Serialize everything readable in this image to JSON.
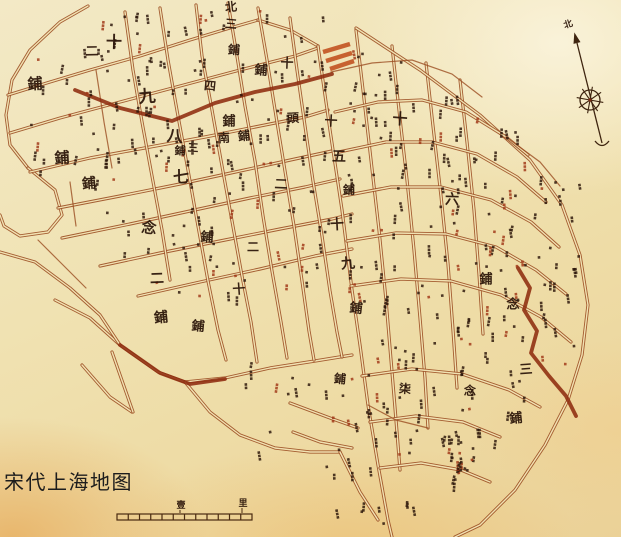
{
  "caption": {
    "text": "宋代上海地图"
  },
  "colors": {
    "ink": "#2a1408",
    "street": "#9b4e22",
    "street_inner": "#f1e2b2",
    "accent": "#8e2c0f",
    "red_block": "#c04a18",
    "red_mark": "#a03616",
    "compass": "#3f2510",
    "scale": "#4a2a10"
  },
  "compass": {
    "north_label": "北",
    "label_pos": [
      569,
      27
    ],
    "top": [
      577,
      43
    ],
    "bottom": [
      602,
      143
    ],
    "wheel_center": [
      590,
      100
    ],
    "wheel_radius": 10
  },
  "scale_bar": {
    "x1": 117,
    "x2": 252,
    "y": 514,
    "height": 6,
    "segments": 12,
    "labels": [
      {
        "text": "壹",
        "x": 181,
        "y": 508
      },
      {
        "text": "里",
        "x": 243,
        "y": 506
      }
    ]
  },
  "district_labels": [
    {
      "t": "北",
      "x": 231,
      "y": 7,
      "s": 12
    },
    {
      "t": "三",
      "x": 231,
      "y": 24,
      "s": 12
    },
    {
      "t": "鋪",
      "x": 234,
      "y": 50,
      "s": 12
    },
    {
      "t": "十",
      "x": 114,
      "y": 42,
      "s": 16
    },
    {
      "t": "二",
      "x": 92,
      "y": 52,
      "s": 13
    },
    {
      "t": "鋪",
      "x": 35,
      "y": 84,
      "s": 15
    },
    {
      "t": "九",
      "x": 147,
      "y": 97,
      "s": 17
    },
    {
      "t": "四",
      "x": 210,
      "y": 86,
      "s": 12
    },
    {
      "t": "鋪",
      "x": 261,
      "y": 71,
      "s": 13
    },
    {
      "t": "十",
      "x": 287,
      "y": 64,
      "s": 13
    },
    {
      "t": "鋪",
      "x": 229,
      "y": 122,
      "s": 13
    },
    {
      "t": "頭",
      "x": 293,
      "y": 118,
      "s": 12
    },
    {
      "t": "南",
      "x": 224,
      "y": 138,
      "s": 12
    },
    {
      "t": "鋪",
      "x": 244,
      "y": 136,
      "s": 12
    },
    {
      "t": "八",
      "x": 175,
      "y": 136,
      "s": 16
    },
    {
      "t": "三",
      "x": 193,
      "y": 148,
      "s": 11
    },
    {
      "t": "鋪",
      "x": 180,
      "y": 151,
      "s": 11
    },
    {
      "t": "七",
      "x": 181,
      "y": 177,
      "s": 16
    },
    {
      "t": "鋪",
      "x": 62,
      "y": 158,
      "s": 15
    },
    {
      "t": "鋪",
      "x": 89,
      "y": 184,
      "s": 14
    },
    {
      "t": "念",
      "x": 149,
      "y": 228,
      "s": 15
    },
    {
      "t": "鋪",
      "x": 207,
      "y": 238,
      "s": 13
    },
    {
      "t": "二",
      "x": 281,
      "y": 185,
      "s": 13
    },
    {
      "t": "二",
      "x": 253,
      "y": 247,
      "s": 12
    },
    {
      "t": "二",
      "x": 157,
      "y": 279,
      "s": 14
    },
    {
      "t": "十",
      "x": 239,
      "y": 290,
      "s": 13
    },
    {
      "t": "鋪",
      "x": 161,
      "y": 318,
      "s": 14
    },
    {
      "t": "鋪",
      "x": 198,
      "y": 327,
      "s": 13
    },
    {
      "t": "十",
      "x": 331,
      "y": 122,
      "s": 13
    },
    {
      "t": "五",
      "x": 339,
      "y": 157,
      "s": 14
    },
    {
      "t": "鋪",
      "x": 349,
      "y": 190,
      "s": 12
    },
    {
      "t": "十",
      "x": 337,
      "y": 225,
      "s": 14
    },
    {
      "t": "九",
      "x": 348,
      "y": 264,
      "s": 14
    },
    {
      "t": "鋪",
      "x": 356,
      "y": 309,
      "s": 13
    },
    {
      "t": "十",
      "x": 400,
      "y": 119,
      "s": 15
    },
    {
      "t": "六",
      "x": 452,
      "y": 200,
      "s": 14
    },
    {
      "t": "鋪",
      "x": 486,
      "y": 280,
      "s": 13
    },
    {
      "t": "念",
      "x": 513,
      "y": 305,
      "s": 13
    },
    {
      "t": "三",
      "x": 526,
      "y": 370,
      "s": 13
    },
    {
      "t": "鋪",
      "x": 516,
      "y": 419,
      "s": 13
    },
    {
      "t": "鋪",
      "x": 340,
      "y": 379,
      "s": 12
    },
    {
      "t": "柒",
      "x": 405,
      "y": 389,
      "s": 12
    },
    {
      "t": "念",
      "x": 470,
      "y": 391,
      "s": 12
    }
  ],
  "streets": {
    "main": [
      [
        [
          88,
          6
        ],
        [
          60,
          22
        ],
        [
          30,
          50
        ],
        [
          12,
          80
        ],
        [
          6,
          115
        ],
        [
          10,
          145
        ],
        [
          28,
          168
        ]
      ],
      [
        [
          28,
          168
        ],
        [
          55,
          190
        ],
        [
          62,
          215
        ],
        [
          48,
          232
        ],
        [
          20,
          236
        ],
        [
          4,
          226
        ],
        [
          0,
          215
        ]
      ],
      [
        [
          8,
          95
        ],
        [
          50,
          82
        ],
        [
          90,
          70
        ],
        [
          140,
          56
        ],
        [
          190,
          40
        ],
        [
          230,
          28
        ],
        [
          258,
          20
        ]
      ],
      [
        [
          258,
          20
        ],
        [
          290,
          30
        ],
        [
          318,
          46
        ]
      ],
      [
        [
          10,
          133
        ],
        [
          60,
          118
        ],
        [
          120,
          102
        ],
        [
          180,
          86
        ],
        [
          240,
          70
        ],
        [
          295,
          56
        ],
        [
          318,
          48
        ]
      ],
      [
        [
          30,
          172
        ],
        [
          90,
          158
        ],
        [
          150,
          147
        ],
        [
          205,
          137
        ],
        [
          255,
          127
        ],
        [
          305,
          117
        ],
        [
          328,
          110
        ]
      ],
      [
        [
          58,
          208
        ],
        [
          120,
          196
        ],
        [
          180,
          184
        ],
        [
          240,
          171
        ],
        [
          295,
          159
        ],
        [
          332,
          151
        ]
      ],
      [
        [
          62,
          238
        ],
        [
          130,
          224
        ],
        [
          190,
          211
        ],
        [
          250,
          198
        ],
        [
          305,
          187
        ],
        [
          340,
          179
        ]
      ],
      [
        [
          100,
          266
        ],
        [
          160,
          253
        ],
        [
          220,
          241
        ],
        [
          280,
          229
        ],
        [
          332,
          219
        ],
        [
          352,
          214
        ]
      ],
      [
        [
          138,
          296
        ],
        [
          200,
          282
        ],
        [
          260,
          269
        ],
        [
          315,
          256
        ],
        [
          352,
          249
        ]
      ],
      [
        [
          55,
          300
        ],
        [
          90,
          318
        ],
        [
          120,
          345
        ],
        [
          158,
          372
        ],
        [
          185,
          382
        ],
        [
          225,
          378
        ],
        [
          270,
          368
        ],
        [
          315,
          361
        ],
        [
          352,
          355
        ]
      ],
      [
        [
          125,
          12
        ],
        [
          133,
          70
        ],
        [
          142,
          122
        ],
        [
          152,
          176
        ],
        [
          162,
          230
        ],
        [
          170,
          280
        ]
      ],
      [
        [
          160,
          8
        ],
        [
          168,
          60
        ],
        [
          178,
          116
        ],
        [
          188,
          170
        ],
        [
          198,
          226
        ],
        [
          208,
          281
        ],
        [
          218,
          330
        ],
        [
          226,
          360
        ]
      ],
      [
        [
          196,
          5
        ],
        [
          202,
          56
        ],
        [
          212,
          110
        ],
        [
          222,
          166
        ],
        [
          232,
          221
        ],
        [
          242,
          276
        ],
        [
          251,
          322
        ],
        [
          257,
          362
        ]
      ],
      [
        [
          228,
          3
        ],
        [
          236,
          50
        ],
        [
          245,
          106
        ],
        [
          255,
          161
        ],
        [
          263,
          216
        ],
        [
          272,
          271
        ],
        [
          281,
          322
        ],
        [
          287,
          358
        ]
      ],
      [
        [
          258,
          8
        ],
        [
          267,
          60
        ],
        [
          276,
          116
        ],
        [
          285,
          171
        ],
        [
          294,
          226
        ],
        [
          302,
          281
        ],
        [
          309,
          331
        ],
        [
          314,
          360
        ]
      ],
      [
        [
          290,
          18
        ],
        [
          297,
          70
        ],
        [
          305,
          126
        ],
        [
          313,
          181
        ],
        [
          322,
          236
        ],
        [
          330,
          291
        ],
        [
          337,
          332
        ],
        [
          342,
          357
        ]
      ],
      [
        [
          318,
          46
        ],
        [
          330,
          130
        ],
        [
          342,
          210
        ],
        [
          352,
          290
        ],
        [
          360,
          345
        ],
        [
          368,
          405
        ],
        [
          378,
          465
        ],
        [
          388,
          520
        ],
        [
          392,
          537
        ]
      ],
      [
        [
          356,
          30
        ],
        [
          363,
          90
        ],
        [
          371,
          160
        ],
        [
          379,
          230
        ],
        [
          386,
          300
        ],
        [
          391,
          360
        ],
        [
          396,
          420
        ],
        [
          400,
          470
        ]
      ],
      [
        [
          392,
          46
        ],
        [
          399,
          110
        ],
        [
          407,
          180
        ],
        [
          414,
          250
        ],
        [
          420,
          318
        ],
        [
          425,
          378
        ],
        [
          428,
          428
        ]
      ],
      [
        [
          426,
          63
        ],
        [
          433,
          126
        ],
        [
          441,
          196
        ],
        [
          448,
          264
        ],
        [
          453,
          330
        ],
        [
          457,
          388
        ]
      ],
      [
        [
          460,
          80
        ],
        [
          467,
          142
        ],
        [
          474,
          210
        ],
        [
          479,
          274
        ],
        [
          483,
          334
        ]
      ],
      [
        [
          356,
          28
        ],
        [
          420,
          70
        ],
        [
          480,
          115
        ],
        [
          530,
          160
        ],
        [
          562,
          205
        ],
        [
          580,
          255
        ],
        [
          588,
          305
        ],
        [
          582,
          355
        ],
        [
          568,
          400
        ],
        [
          545,
          445
        ],
        [
          515,
          490
        ],
        [
          480,
          525
        ],
        [
          455,
          537
        ]
      ],
      [
        [
          335,
          112
        ],
        [
          378,
          102
        ],
        [
          422,
          100
        ],
        [
          466,
          112
        ],
        [
          506,
          137
        ],
        [
          528,
          155
        ]
      ],
      [
        [
          339,
          152
        ],
        [
          386,
          142
        ],
        [
          432,
          142
        ],
        [
          477,
          154
        ],
        [
          517,
          177
        ],
        [
          546,
          202
        ]
      ],
      [
        [
          343,
          196
        ],
        [
          391,
          187
        ],
        [
          441,
          187
        ],
        [
          491,
          200
        ],
        [
          531,
          222
        ],
        [
          559,
          247
        ]
      ],
      [
        [
          347,
          241
        ],
        [
          396,
          233
        ],
        [
          446,
          234
        ],
        [
          496,
          247
        ],
        [
          536,
          270
        ],
        [
          566,
          294
        ]
      ],
      [
        [
          351,
          286
        ],
        [
          401,
          279
        ],
        [
          451,
          281
        ],
        [
          501,
          295
        ],
        [
          541,
          317
        ],
        [
          571,
          342
        ]
      ],
      [
        [
          362,
          376
        ],
        [
          412,
          369
        ],
        [
          462,
          374
        ],
        [
          509,
          390
        ],
        [
          540,
          407
        ]
      ],
      [
        [
          370,
          422
        ],
        [
          416,
          416
        ],
        [
          463,
          422
        ],
        [
          500,
          437
        ]
      ],
      [
        [
          380,
          468
        ],
        [
          421,
          463
        ],
        [
          461,
          470
        ],
        [
          490,
          482
        ]
      ],
      [
        [
          82,
          365
        ],
        [
          110,
          397
        ],
        [
          132,
          412
        ]
      ],
      [
        [
          112,
          352
        ],
        [
          133,
          412
        ]
      ],
      [
        [
          185,
          382
        ],
        [
          210,
          412
        ],
        [
          240,
          435
        ],
        [
          275,
          448
        ],
        [
          310,
          452
        ],
        [
          340,
          452
        ]
      ],
      [
        [
          340,
          452
        ],
        [
          360,
          492
        ],
        [
          378,
          520
        ]
      ],
      [
        [
          290,
          403
        ],
        [
          330,
          418
        ],
        [
          358,
          428
        ]
      ],
      [
        [
          293,
          432
        ],
        [
          320,
          442
        ],
        [
          352,
          448
        ]
      ],
      [
        [
          0,
          252
        ],
        [
          35,
          262
        ],
        [
          70,
          288
        ],
        [
          100,
          315
        ],
        [
          120,
          345
        ]
      ]
    ],
    "minor": [
      [
        [
          96,
          70
        ],
        [
          104,
          122
        ],
        [
          112,
          168
        ]
      ],
      [
        [
          70,
          182
        ],
        [
          76,
          226
        ]
      ],
      [
        [
          38,
          240
        ],
        [
          60,
          262
        ],
        [
          86,
          288
        ]
      ],
      [
        [
          331,
          72
        ],
        [
          372,
          63
        ],
        [
          412,
          60
        ],
        [
          452,
          74
        ],
        [
          482,
          97
        ]
      ],
      [
        [
          506,
          137
        ],
        [
          540,
          162
        ],
        [
          560,
          186
        ]
      ],
      [
        [
          368,
          405
        ],
        [
          396,
          420
        ]
      ],
      [
        [
          396,
          420
        ],
        [
          428,
          428
        ]
      ]
    ],
    "accent": [
      [
        [
          75,
          90
        ],
        [
          120,
          108
        ],
        [
          172,
          121
        ],
        [
          215,
          103
        ],
        [
          255,
          92
        ],
        [
          295,
          84
        ],
        [
          332,
          74
        ]
      ],
      [
        [
          518,
          268
        ],
        [
          530,
          288
        ],
        [
          524,
          310
        ],
        [
          537,
          331
        ],
        [
          531,
          353
        ],
        [
          549,
          376
        ],
        [
          566,
          396
        ],
        [
          576,
          416
        ]
      ],
      [
        [
          120,
          345
        ],
        [
          160,
          373
        ],
        [
          190,
          384
        ],
        [
          225,
          379
        ]
      ]
    ],
    "red_blocks": [
      [
        [
          323,
          52
        ],
        [
          350,
          44
        ]
      ],
      [
        [
          326,
          61
        ],
        [
          352,
          53
        ]
      ],
      [
        [
          330,
          69
        ],
        [
          354,
          61
        ]
      ]
    ]
  },
  "mark_regions": [
    {
      "x0": 25,
      "y0": 10,
      "x1": 330,
      "y1": 298,
      "count": 170,
      "zone": "west"
    },
    {
      "x0": 340,
      "y0": 42,
      "x1": 585,
      "y1": 440,
      "count": 195,
      "zone": "east"
    },
    {
      "x0": 235,
      "y0": 358,
      "x1": 420,
      "y1": 525,
      "count": 38,
      "zone": "south"
    },
    {
      "x0": 445,
      "y0": 428,
      "x1": 560,
      "y1": 532,
      "count": 26,
      "zone": "southeast"
    }
  ]
}
